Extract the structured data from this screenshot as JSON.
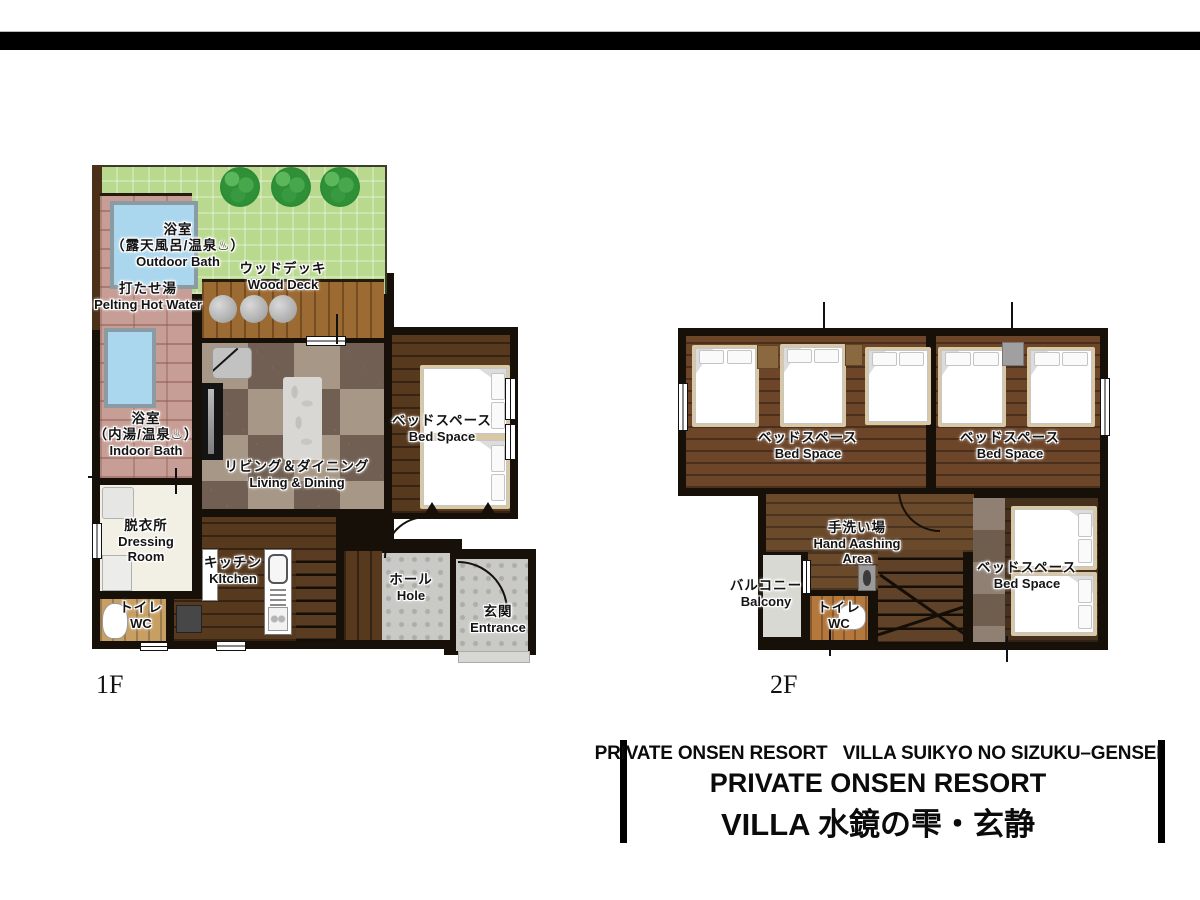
{
  "floor1": {
    "floor_label": "1F",
    "outdoor_bath": {
      "jp1": "浴室",
      "jp2": "（露天風呂/温泉♨）",
      "en": "Outdoor Bath"
    },
    "pelting": {
      "jp": "打たせ湯",
      "en": "Pelting Hot Water"
    },
    "wood_deck": {
      "jp": "ウッドデッキ",
      "en": "Wood Deck"
    },
    "indoor_bath": {
      "jp1": "浴室",
      "jp2": "（内湯/温泉♨）",
      "en": "Indoor Bath"
    },
    "living": {
      "jp": "リビング＆ダイニング",
      "en": "Living & Dining"
    },
    "bed_space": {
      "jp": "ベッドスペース",
      "en": "Bed Space"
    },
    "dressing": {
      "jp": "脱衣所",
      "en1": "Dressing",
      "en2": "Room"
    },
    "wc": {
      "jp": "トイレ",
      "en": "WC"
    },
    "kitchen": {
      "jp": "キッチン",
      "en": "KItchen"
    },
    "hall": {
      "jp": "ホール",
      "en": "Hole"
    },
    "entrance": {
      "jp": "玄関",
      "en": "Entrance"
    }
  },
  "floor2": {
    "floor_label": "2F",
    "bed_space_a": {
      "jp": "ベッドスペース",
      "en": "Bed Space"
    },
    "bed_space_b": {
      "jp": "ベッドスペース",
      "en": "Bed Space"
    },
    "bed_space_c": {
      "jp": "ベッドスペース",
      "en": "Bed Space"
    },
    "hand_washing": {
      "jp": "手洗い場",
      "en1": "Hand Aashing",
      "en2": "Area"
    },
    "balcony": {
      "jp": "バルコニー",
      "en": "Balcony"
    },
    "wc": {
      "jp": "トイレ",
      "en": "WC"
    }
  },
  "title_block": {
    "subtitle": "PRIVATE ONSEN RESORT   VILLA SUIKYO NO SIZUKU–GENSEI",
    "title_en": "PRIVATE ONSEN RESORT",
    "title_jp": "VILLA 水鏡の雫・玄静"
  },
  "colors": {
    "wall": "#171009",
    "lawn": "#b9da8e",
    "tree": "#2f9038",
    "brick": "#c79e95",
    "pool": "#abd7ee",
    "deck": "#9c6a33",
    "checker_light": "#a79786",
    "checker_dark": "#70f5f52",
    "wood_dark": "#57391e",
    "wood_2f": "#6d462a",
    "stone": "#c9cac6",
    "balcony": "#d9d9d4",
    "dressing_room": "#f2efe4",
    "top_bar": "#000000"
  }
}
